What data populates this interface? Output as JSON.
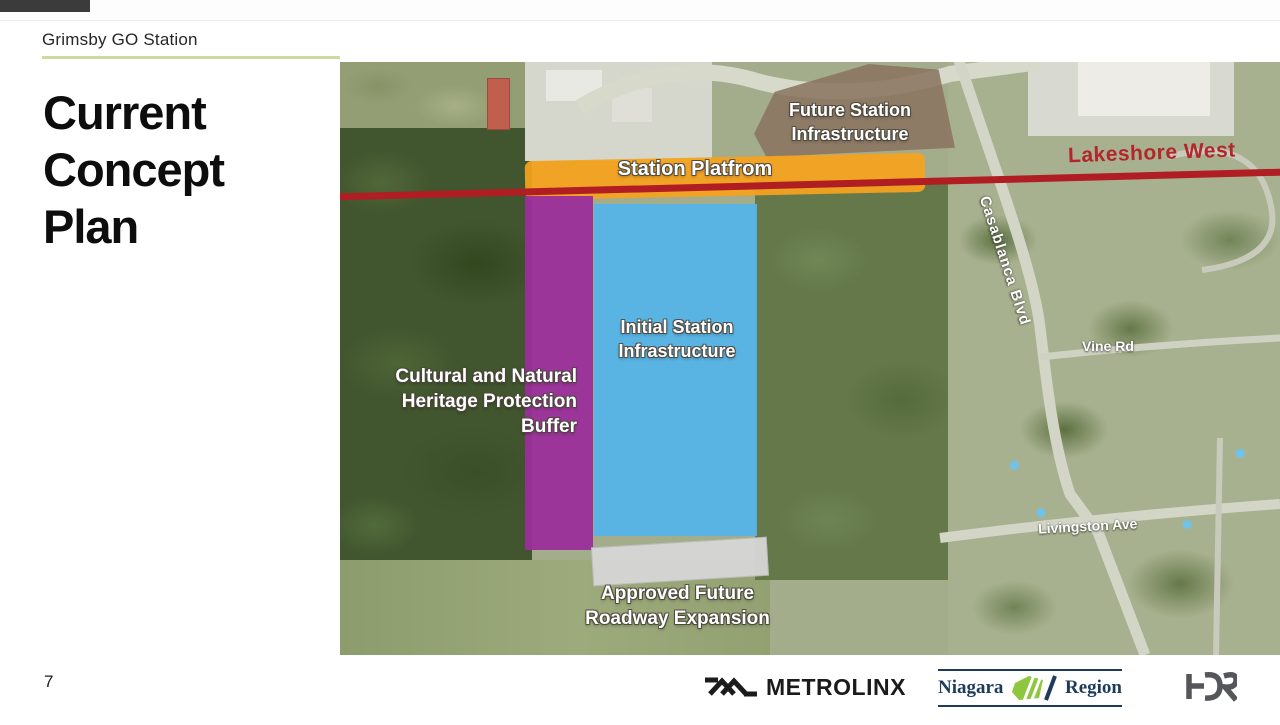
{
  "slide": {
    "eyebrow": "Grimsby GO Station",
    "title_lines": [
      "Current",
      "Concept",
      "Plan"
    ],
    "page_number": "7"
  },
  "map": {
    "overlays": {
      "future_station_lines": [
        "Future Station",
        "Infrastructure"
      ],
      "station_platform": "Station Platfrom",
      "rail_corridor_label": "Lakeshore West",
      "initial_station_lines": [
        "Initial Station",
        "Infrastructure"
      ],
      "heritage_buffer_lines": [
        "Cultural and Natural",
        "Heritage Protection",
        "Buffer"
      ],
      "roadway_expansion_lines": [
        "Approved Future",
        "Roadway Expansion"
      ]
    },
    "road_labels": {
      "casablanca": "Casablanca Blvd",
      "vine": "Vine Rd",
      "livingston": "Livingston Ave"
    },
    "legend_colors": {
      "station_platform": "#F6A31D",
      "rail_line": "#B01E24",
      "rail_label": "#B3262B",
      "heritage_buffer": "#9C2E9B",
      "initial_station": "#56B4E8",
      "future_station": "#8B7461",
      "roadway_expansion": "#D5D5D5"
    }
  },
  "footer": {
    "metrolinx_label": "METROLINX",
    "niagara_left": "Niagara",
    "niagara_right": "Region",
    "hdr_label": "HDR",
    "brand_colors": {
      "niagara_navy": "#1D3C5C",
      "niagara_green": "#8DC63F",
      "metrolinx_black": "#1B1B1B",
      "hdr_gray": "#55565A"
    }
  },
  "theme": {
    "background": "#FFFFFF",
    "header_underline": "#C9DB9D",
    "title_color": "#0D0D0D"
  }
}
